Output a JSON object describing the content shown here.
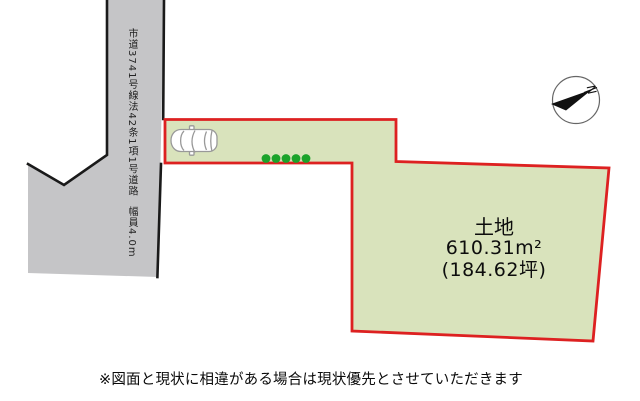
{
  "diagram": {
    "type": "real-estate-lot-plan",
    "background_color": "#ffffff"
  },
  "road": {
    "name_label": "市道3741号線法42条1項1号道路",
    "width_label": "幅員4.0m",
    "fill_color": "#c5c5c7",
    "outline_color": "#1a1a1a"
  },
  "parcel": {
    "title": "土地",
    "area_sqm": "610.31m²",
    "area_tsubo": "(184.62坪)",
    "fill_color": "#d9e3bc",
    "border_color": "#dd2121"
  },
  "markers": {
    "plant_dot_count": 5,
    "plant_dot_color": "#1ba32b"
  },
  "compass": {
    "label": "N"
  },
  "footer": {
    "disclaimer": "※図面と現状に相違がある場合は現状優先とさせていただきます"
  }
}
